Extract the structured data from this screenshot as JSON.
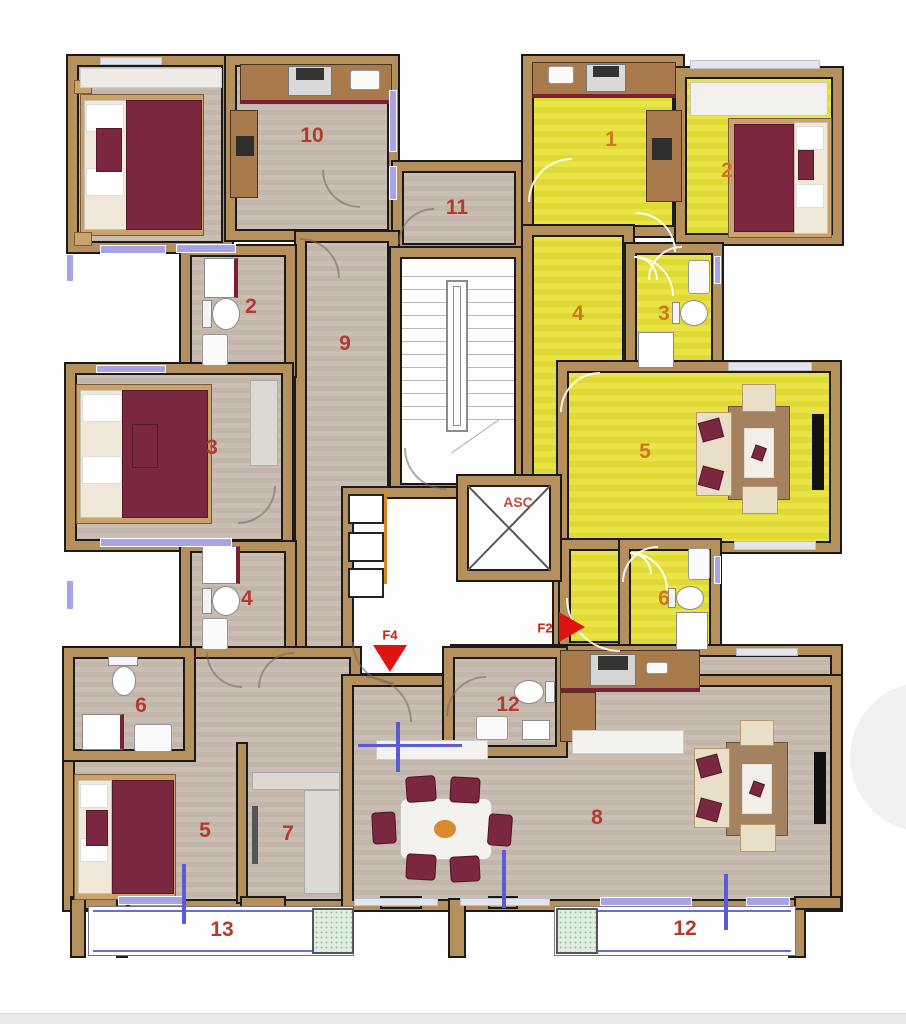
{
  "title": "Apartment floor plan",
  "elevator_label": "ASC",
  "exits": {
    "f2": "F2",
    "f4": "F4"
  },
  "rooms": {
    "corridor": "11",
    "left_apartment": {
      "kitchen": "10",
      "bath_top": "2",
      "hallway": "9",
      "bedroom_mid": "3",
      "bath_bottom": "4"
    },
    "yellow_apartment": {
      "kitchen": "1",
      "bedroom": "2",
      "bath_top": "3",
      "hallway": "4",
      "living": "5",
      "bath_bottom": "6"
    },
    "bottom_left_apartment": {
      "bath": "6",
      "bedroom": "5",
      "closet": "7",
      "balcony": "13"
    },
    "bottom_right_apartment": {
      "bath": "12",
      "living": "8",
      "balcony": "12"
    }
  },
  "colors": {
    "wall": "#b5905c",
    "floor_gray": "#c6bab0",
    "floor_yellow": "#e6e03e",
    "bed_maroon": "#7b2740",
    "window_glass": "#a8a3e5",
    "label_red": "#b23a2e",
    "label_orange": "#cd7722",
    "arrow_red": "#e01313",
    "railing_blue": "#6b6bd8",
    "planter_green": "#dfeede"
  }
}
